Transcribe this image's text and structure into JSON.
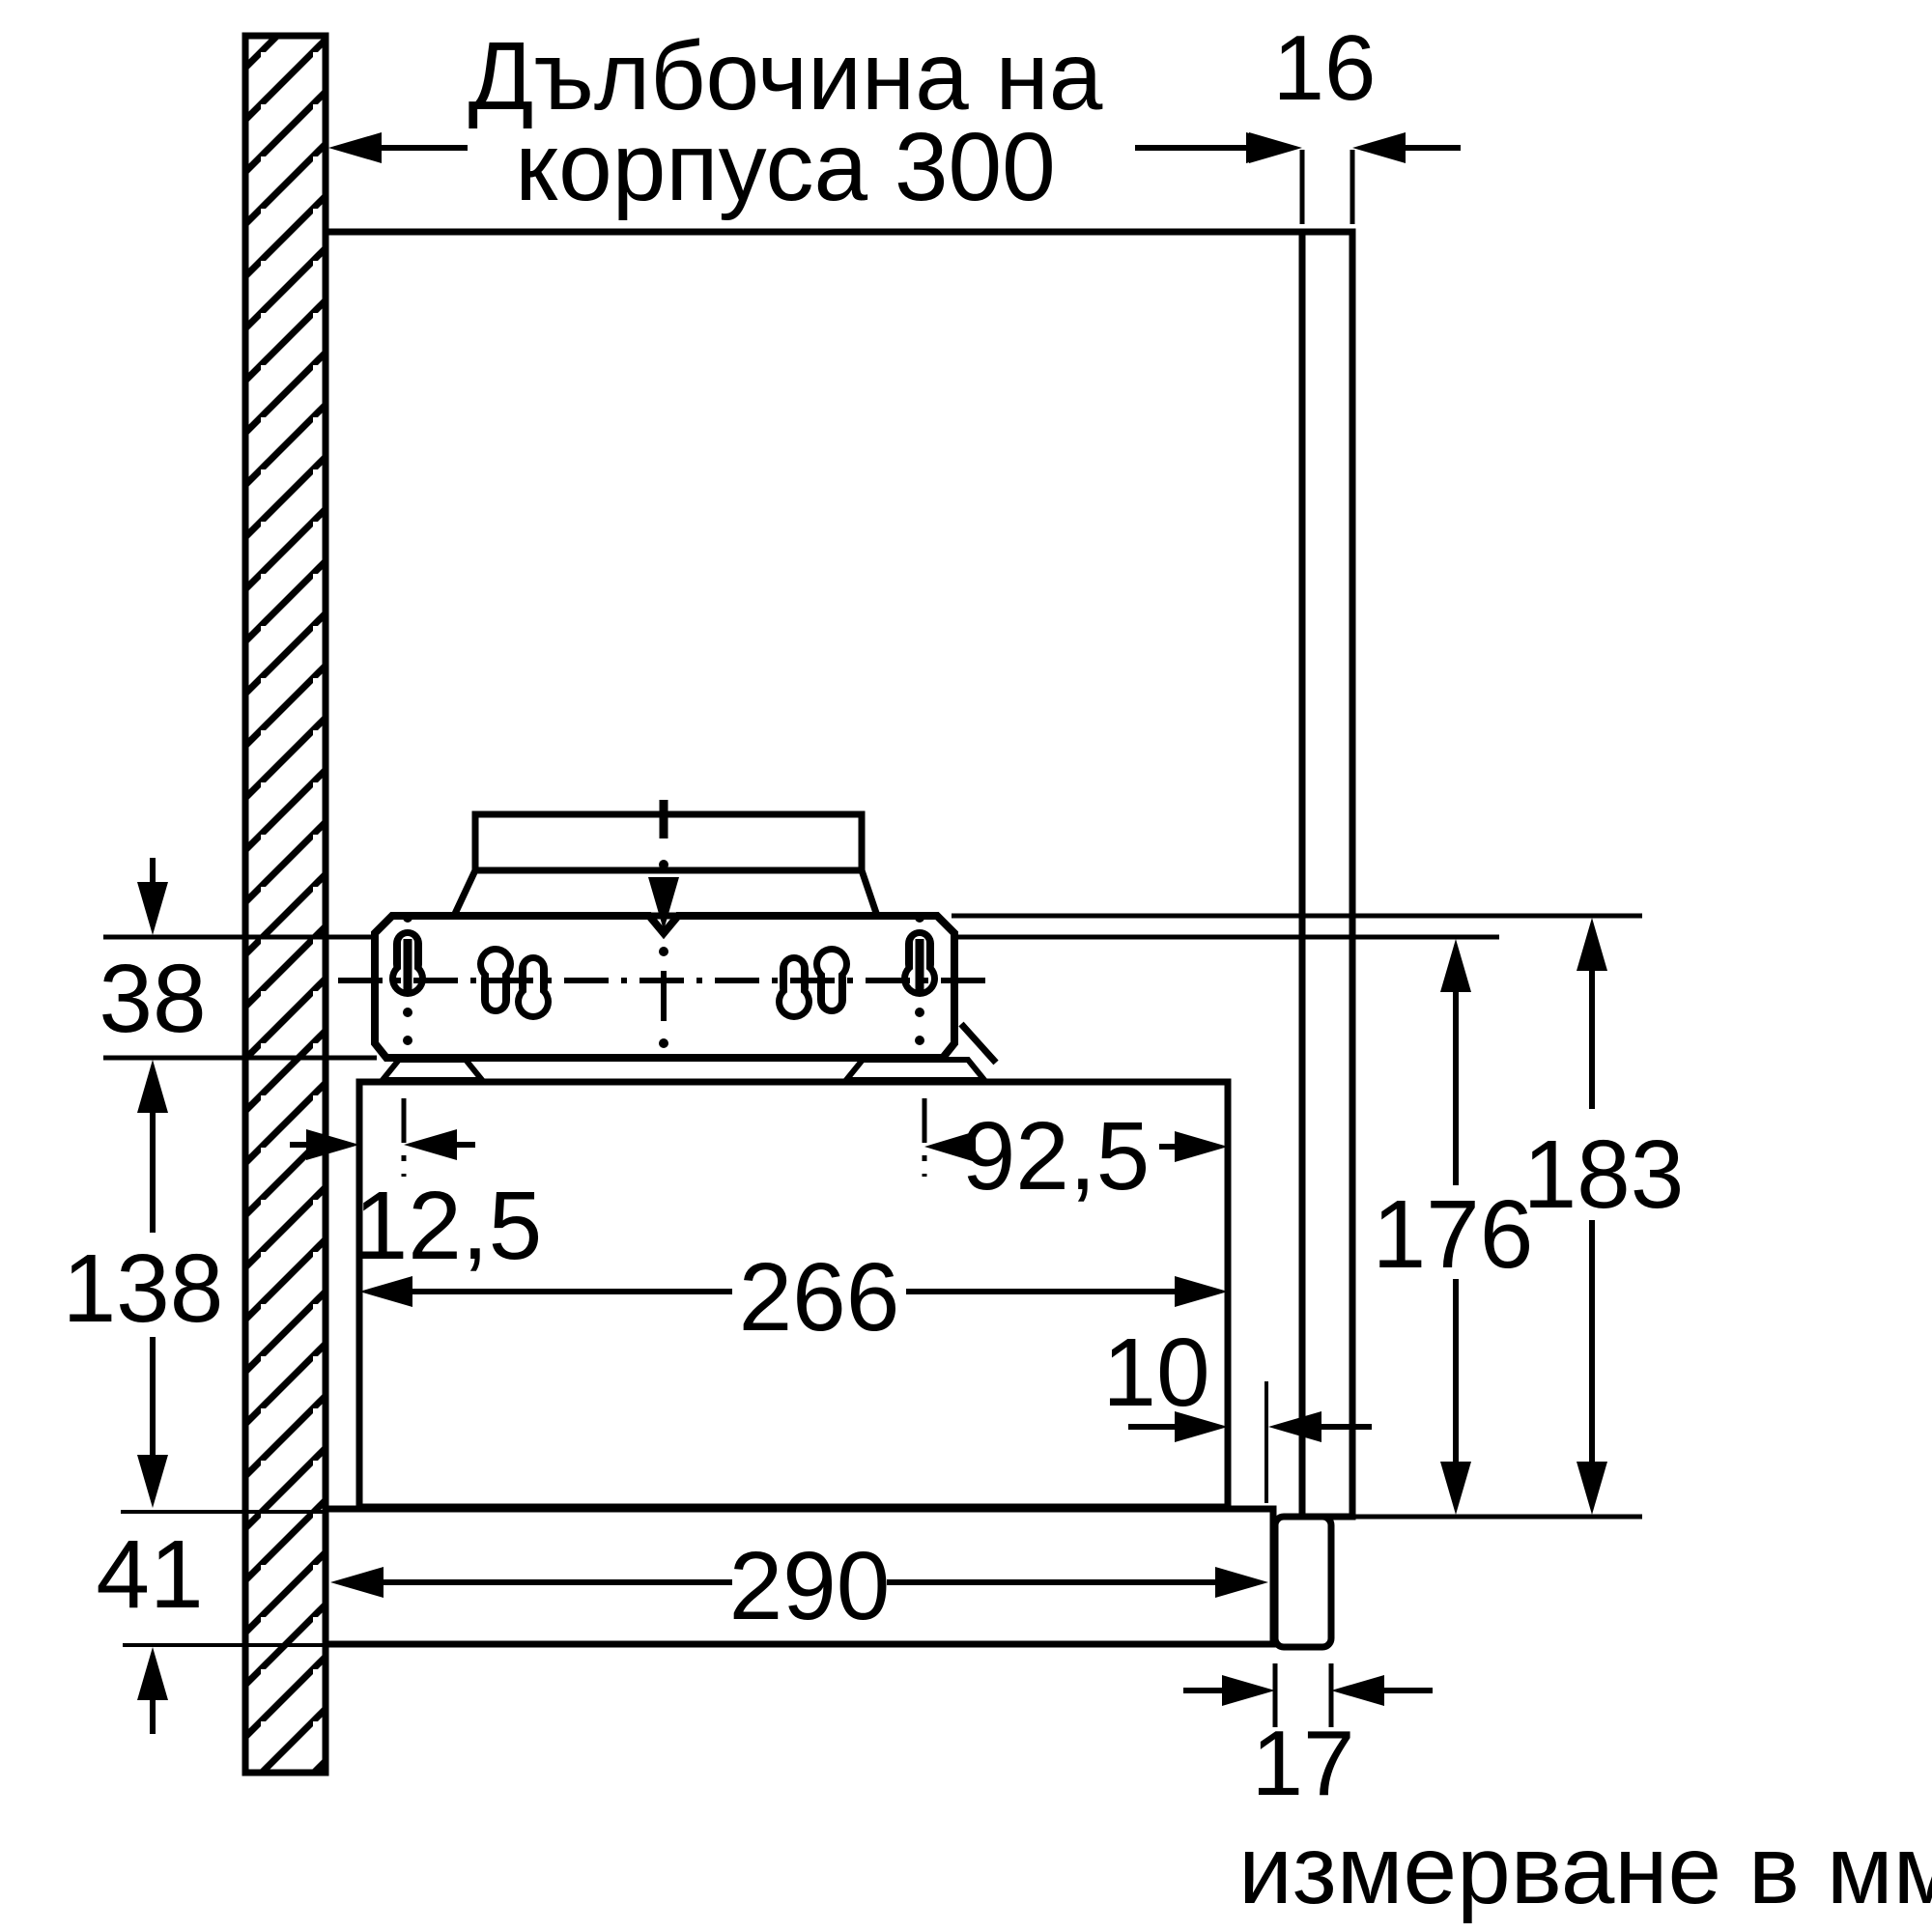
{
  "diagram": {
    "title_line1": "Дълбочина на",
    "title_line2": "корпуса 300",
    "footer_note": "измерване в мм",
    "colors": {
      "line": "#000000",
      "background": "#ffffff"
    },
    "labels": {
      "dim_panel_thickness": "16",
      "dim_offset_top": "38",
      "dim_body_height": "138",
      "dim_bottom_strip": "41",
      "dim_keyhole_offset_left": "12,5",
      "dim_keyhole_offset_right": "92,5",
      "dim_body_depth": "266",
      "dim_rear_gap": "10",
      "dim_strip_depth": "290",
      "dim_block_thickness": "17",
      "dim_height_inner": "176",
      "dim_height_outer": "183"
    }
  }
}
